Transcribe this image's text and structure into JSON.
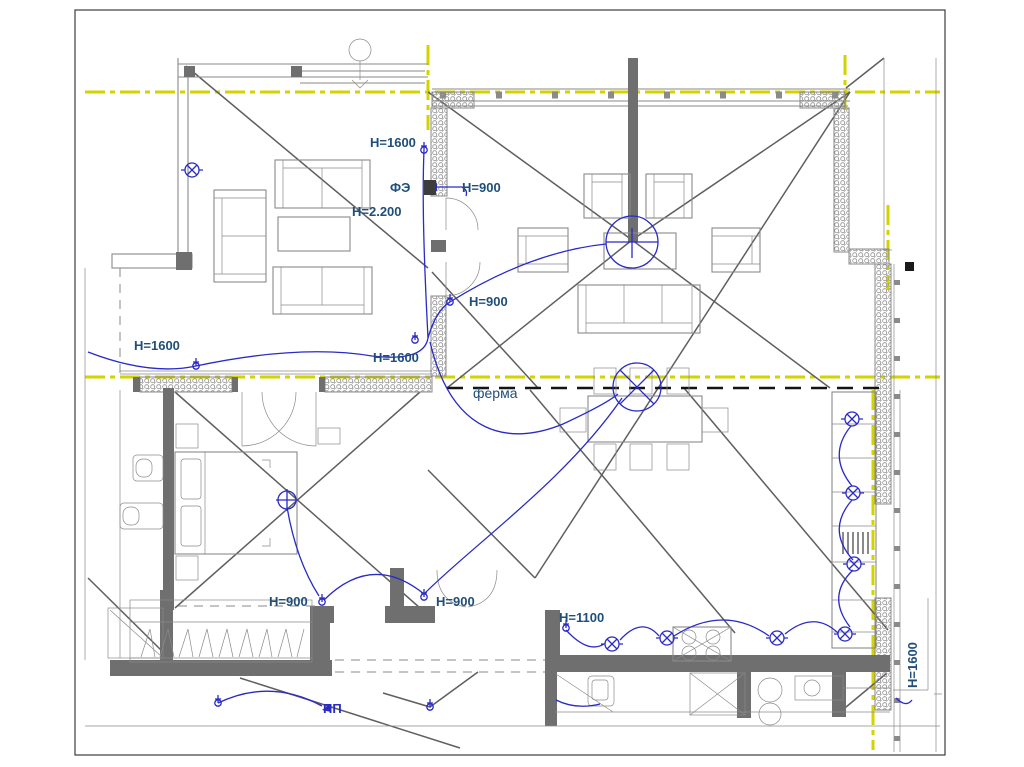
{
  "slide": {
    "background": "#ffffff",
    "border_color": "#3c3c3c",
    "content": "architectural electrical floor plan"
  },
  "colors": {
    "wall": "#6f6f6f",
    "line": "#8a8a8a",
    "roof": "#5f5f5f",
    "axis": "#d3d300",
    "wire": "#2a2ac6",
    "label": "#1f4e79",
    "truss": "#141414",
    "insulation": "#8f8f8f"
  },
  "labels": [
    {
      "id": "h1600-top",
      "text": "H=1600"
    },
    {
      "id": "fe-panel",
      "text": "ФЭ"
    },
    {
      "id": "h900-top",
      "text": "H=900"
    },
    {
      "id": "h2200",
      "text": "H=2.200"
    },
    {
      "id": "h900-mid",
      "text": "H=900"
    },
    {
      "id": "h1600-left",
      "text": "H=1600"
    },
    {
      "id": "h1600-mid",
      "text": "H=1600"
    },
    {
      "id": "ferma-truss",
      "text": "ферма"
    },
    {
      "id": "h900-bedroom",
      "text": "H=900"
    },
    {
      "id": "h900-hall",
      "text": "H=900"
    },
    {
      "id": "h1100",
      "text": "H=1100"
    },
    {
      "id": "pp",
      "text": "ПП"
    },
    {
      "id": "h1600-right",
      "text": "H=1600"
    }
  ],
  "symbols": {
    "ceiling_light": "circle with cross",
    "wall_outlet": "circle with X and side ticks",
    "socket": "small circle with stem",
    "axis_line": "yellow dash-dot",
    "truss_line": "black bold dashed"
  }
}
